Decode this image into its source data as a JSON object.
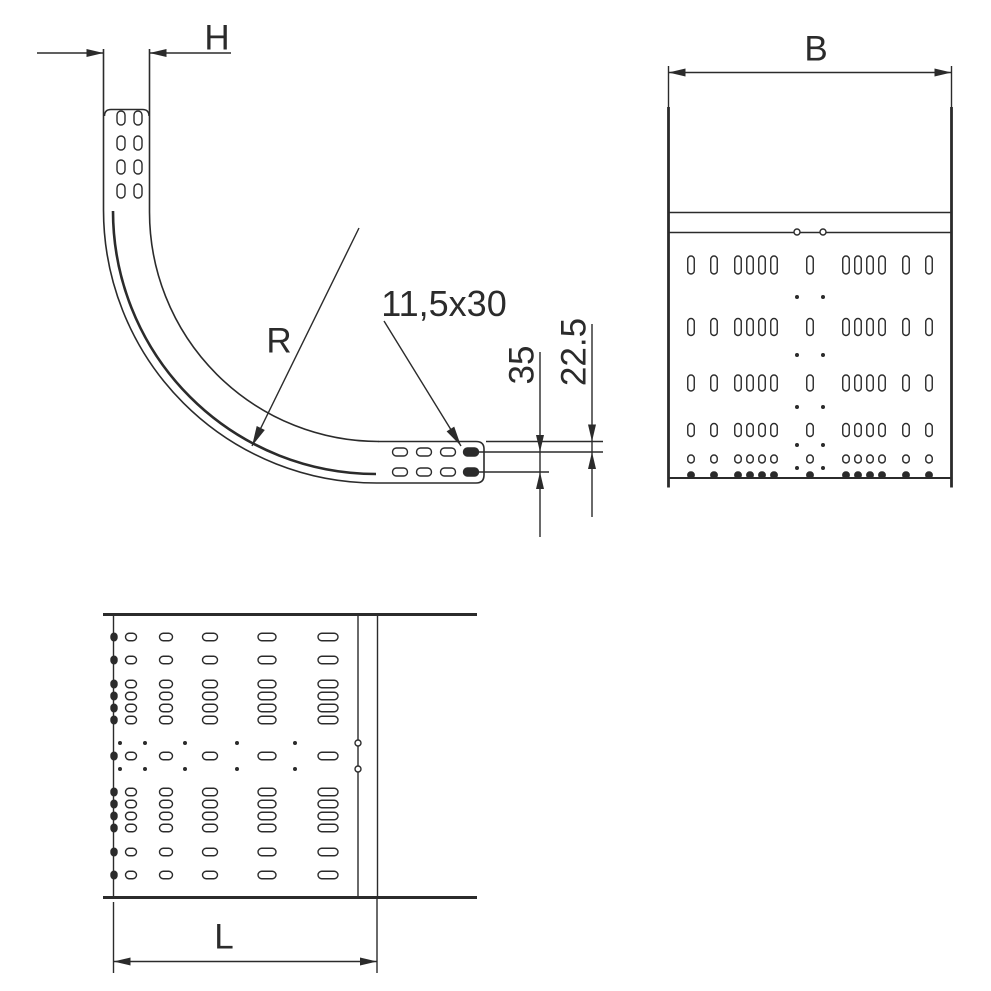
{
  "drawing": {
    "background": "#ffffff",
    "line_color": "#2b2b2b",
    "labels": {
      "height": "H",
      "width": "B",
      "radius": "R",
      "length": "L",
      "slot_size": "11,5x30",
      "end_height": "35",
      "slot_offset": "22.5"
    },
    "perforation": {
      "width_slot_offsets": [
        -119,
        -96,
        -72,
        -60,
        -48,
        -36,
        0,
        36,
        48,
        60,
        72,
        96,
        119
      ],
      "width_dot_offsets": [
        -13,
        13
      ],
      "rear_view": {
        "center_x": 810,
        "slot_w": 6.5,
        "slot_rows": [
          {
            "y": 265,
            "h": 18
          },
          {
            "y": 327,
            "h": 17
          },
          {
            "y": 383,
            "h": 16
          },
          {
            "y": 430,
            "h": 13
          },
          {
            "y": 459,
            "h": 8
          },
          {
            "y": 475,
            "h": 6,
            "filled": true
          }
        ],
        "dot_rows": [
          {
            "y": 232,
            "r": 3,
            "ring": true
          },
          {
            "y": 297,
            "r": 2
          },
          {
            "y": 355,
            "r": 2
          },
          {
            "y": 407,
            "r": 2
          },
          {
            "y": 445,
            "r": 2
          },
          {
            "y": 468,
            "r": 2
          }
        ]
      },
      "plan_view": {
        "center_y": 756,
        "slot_h": 7.5,
        "slot_cols": [
          {
            "x": 328,
            "w": 20
          },
          {
            "x": 267,
            "w": 18
          },
          {
            "x": 210,
            "w": 15
          },
          {
            "x": 166,
            "w": 13
          },
          {
            "x": 131,
            "w": 11
          },
          {
            "x": 114,
            "w": 6,
            "filled": true
          }
        ],
        "dot_cols": [
          {
            "x": 358,
            "r": 3,
            "ring": true
          },
          {
            "x": 295,
            "r": 2
          },
          {
            "x": 237,
            "r": 2
          },
          {
            "x": 185,
            "r": 2
          },
          {
            "x": 145,
            "r": 2
          },
          {
            "x": 120,
            "r": 2
          }
        ]
      },
      "connector_slots": {
        "vertical_end": {
          "col_centers": [
            121,
            138
          ],
          "row_centers": [
            118,
            143,
            167,
            191
          ],
          "w": 8,
          "h": 14
        },
        "horizontal_end": {
          "col_centers": [
            400,
            424,
            448,
            471
          ],
          "row_centers": [
            452,
            472
          ],
          "w": 15,
          "h": 8
        }
      }
    }
  }
}
